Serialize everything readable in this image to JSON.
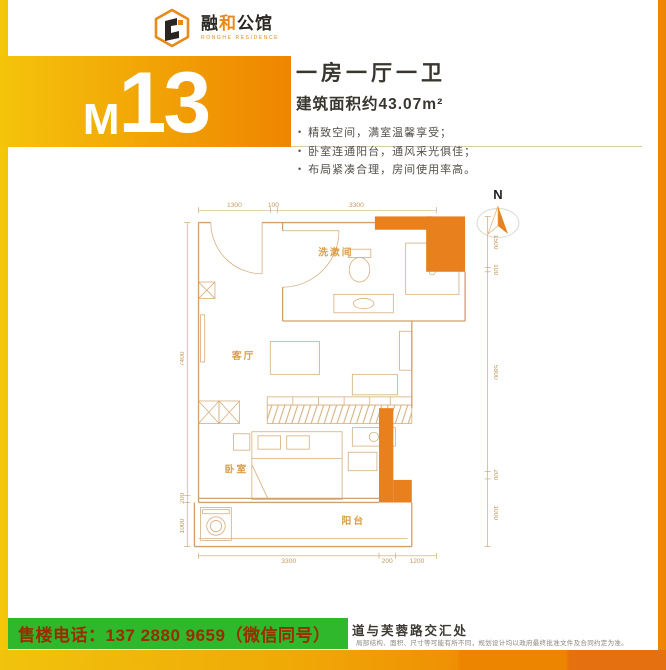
{
  "brand": {
    "char1": "融",
    "char2": "和",
    "char3": "公馆",
    "subtitle": "RONGHE RESIDENCE",
    "accent_color": "#e8891a"
  },
  "unit": {
    "prefix": "M",
    "number": "13"
  },
  "summary": {
    "layout_title": "一房一厅一卫",
    "area": "建筑面积约43.07m²",
    "bullets": [
      "精致空间，满室温馨享受；",
      "卧室连通阳台，通风采光俱佳；",
      "布局紧凑合理，房间使用率高。"
    ]
  },
  "compass": {
    "label": "N"
  },
  "floorplan": {
    "accent_color": "#e8801e",
    "line_color": "#cfa16e",
    "rooms": {
      "washroom": "洗漱间",
      "living": "客厅",
      "bedroom": "卧室",
      "balcony": "阳台"
    },
    "dims": {
      "top": [
        "1300",
        "100",
        "3300"
      ],
      "right": [
        "1500",
        "100",
        "5800",
        "200",
        "1000"
      ],
      "bottom": [
        "3300",
        "200",
        "1200"
      ],
      "left": [
        "7400",
        "200",
        "1000"
      ]
    }
  },
  "footer": {
    "phone": "售楼电话：137 2880 9659（微信同号）",
    "address_fragment": "道与芙蓉路交汇处",
    "disclaimer": "局部结构、面积、尺寸等可能有所不同，规划设计均以政府最终批准文件及合同约定为准。",
    "banner_bg": "#2fb82b",
    "banner_text_color": "#9b2c00"
  }
}
